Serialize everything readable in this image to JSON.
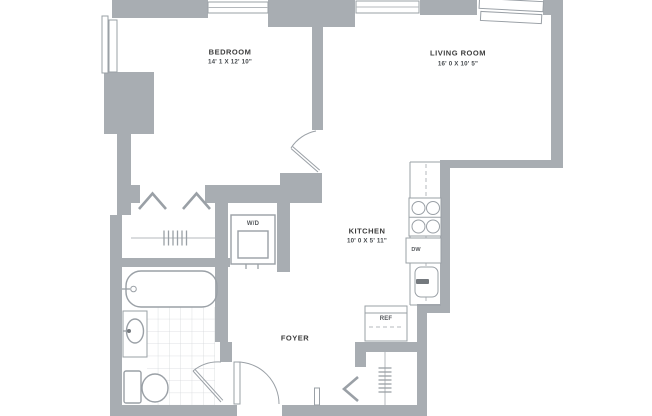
{
  "plan": {
    "rooms": [
      {
        "name": "BEDROOM",
        "dims": "14' 1 X 12' 10\""
      },
      {
        "name": "LIVING ROOM",
        "dims": "16' 0 X 10' 5\""
      },
      {
        "name": "KITCHEN",
        "dims": "10' 0 X 5' 11\""
      },
      {
        "name": "FOYER",
        "dims": ""
      }
    ],
    "appliances": {
      "washer_dryer": "W/D",
      "dishwasher": "DW",
      "refrigerator": "REF"
    },
    "colors": {
      "wall": "#a8adb2",
      "line": "#9aa0a6",
      "light_line": "#b4b8bc",
      "tile_line": "#d5d8db",
      "label": "#3c3c3c",
      "background": "#ffffff"
    }
  }
}
